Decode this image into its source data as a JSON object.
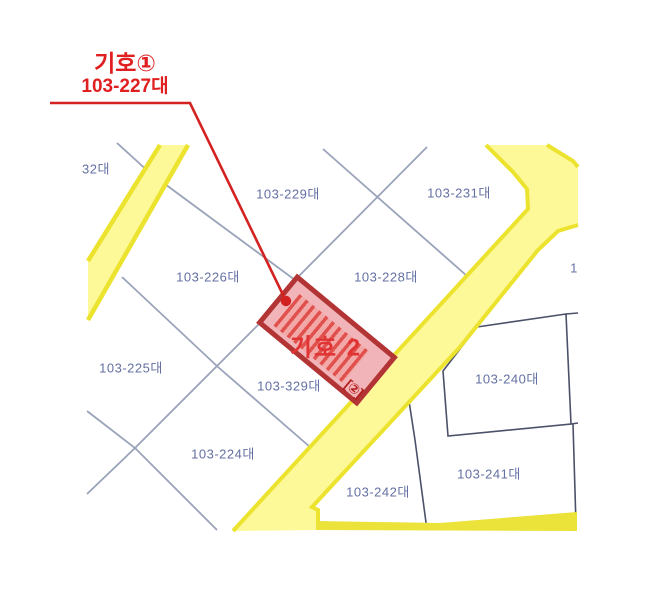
{
  "map": {
    "title": "cadastral-parcel-map",
    "callout": {
      "title": "기호①",
      "parcel": "103-227대"
    },
    "highlight": {
      "label": "기호 2",
      "symbol": "[②]"
    },
    "parcel_labels": [
      {
        "text": "32대"
      },
      {
        "text": "103-229대"
      },
      {
        "text": "103-231대"
      },
      {
        "text": "103-226대"
      },
      {
        "text": "103-228대"
      },
      {
        "text": "103-225대"
      },
      {
        "text": "103-329대"
      },
      {
        "text": "103-240대"
      },
      {
        "text": "103-224대"
      },
      {
        "text": "103-242대"
      },
      {
        "text": "103-241대"
      },
      {
        "text": "1"
      }
    ],
    "colors": {
      "road_fill": "#fdf998",
      "road_edge": "#ece32f",
      "boundary_light": "#9ba3ba",
      "boundary_dark": "#4b5168",
      "label_text": "#6470a3",
      "highlight_border": "#b23434",
      "highlight_fill": "#f1b4b8",
      "highlight_text": "#e13333",
      "callout_red": "#e02020"
    }
  }
}
